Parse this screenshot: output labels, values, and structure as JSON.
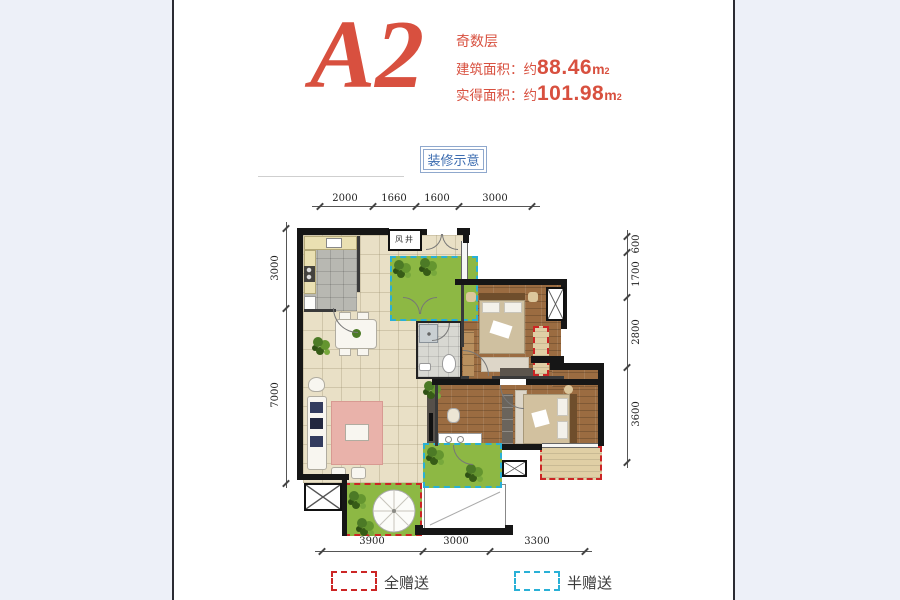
{
  "page": {
    "background": "#edf0f8",
    "panel_background": "#ffffff"
  },
  "header": {
    "unit_name": "A2",
    "floor_note": "奇数层",
    "accent_color": "#d8503f",
    "building_area": {
      "label": "建筑面积：约",
      "value": "88.46",
      "unit": "m",
      "sup": "2"
    },
    "actual_area": {
      "label": "实得面积：约",
      "value": "101.98",
      "unit": "m",
      "sup": "2"
    }
  },
  "decor_badge": {
    "label": "装修示意",
    "color": "#3c6cb0"
  },
  "floor_plan": {
    "labels": {
      "wind_shaft": "风井"
    },
    "dimensions": {
      "top": [
        "2000",
        "1660",
        "1600",
        "3000"
      ],
      "left": [
        "3000",
        "7000"
      ],
      "right": [
        "600",
        "1700",
        "2800",
        "3600"
      ],
      "bottom": [
        "3900",
        "3000",
        "3300"
      ]
    },
    "colors": {
      "wall": "#161616",
      "wood_floor": "#9b6c41",
      "tile_floor": "#e9e0c6",
      "garden_green": "#8db844",
      "full_gift_dash": "#cc2525",
      "half_gift_dash": "#29b0d6"
    }
  },
  "legend": {
    "full_gift": {
      "label": "全赠送",
      "color": "#cc2525"
    },
    "half_gift": {
      "label": "半赠送",
      "color": "#29b0d6"
    }
  }
}
